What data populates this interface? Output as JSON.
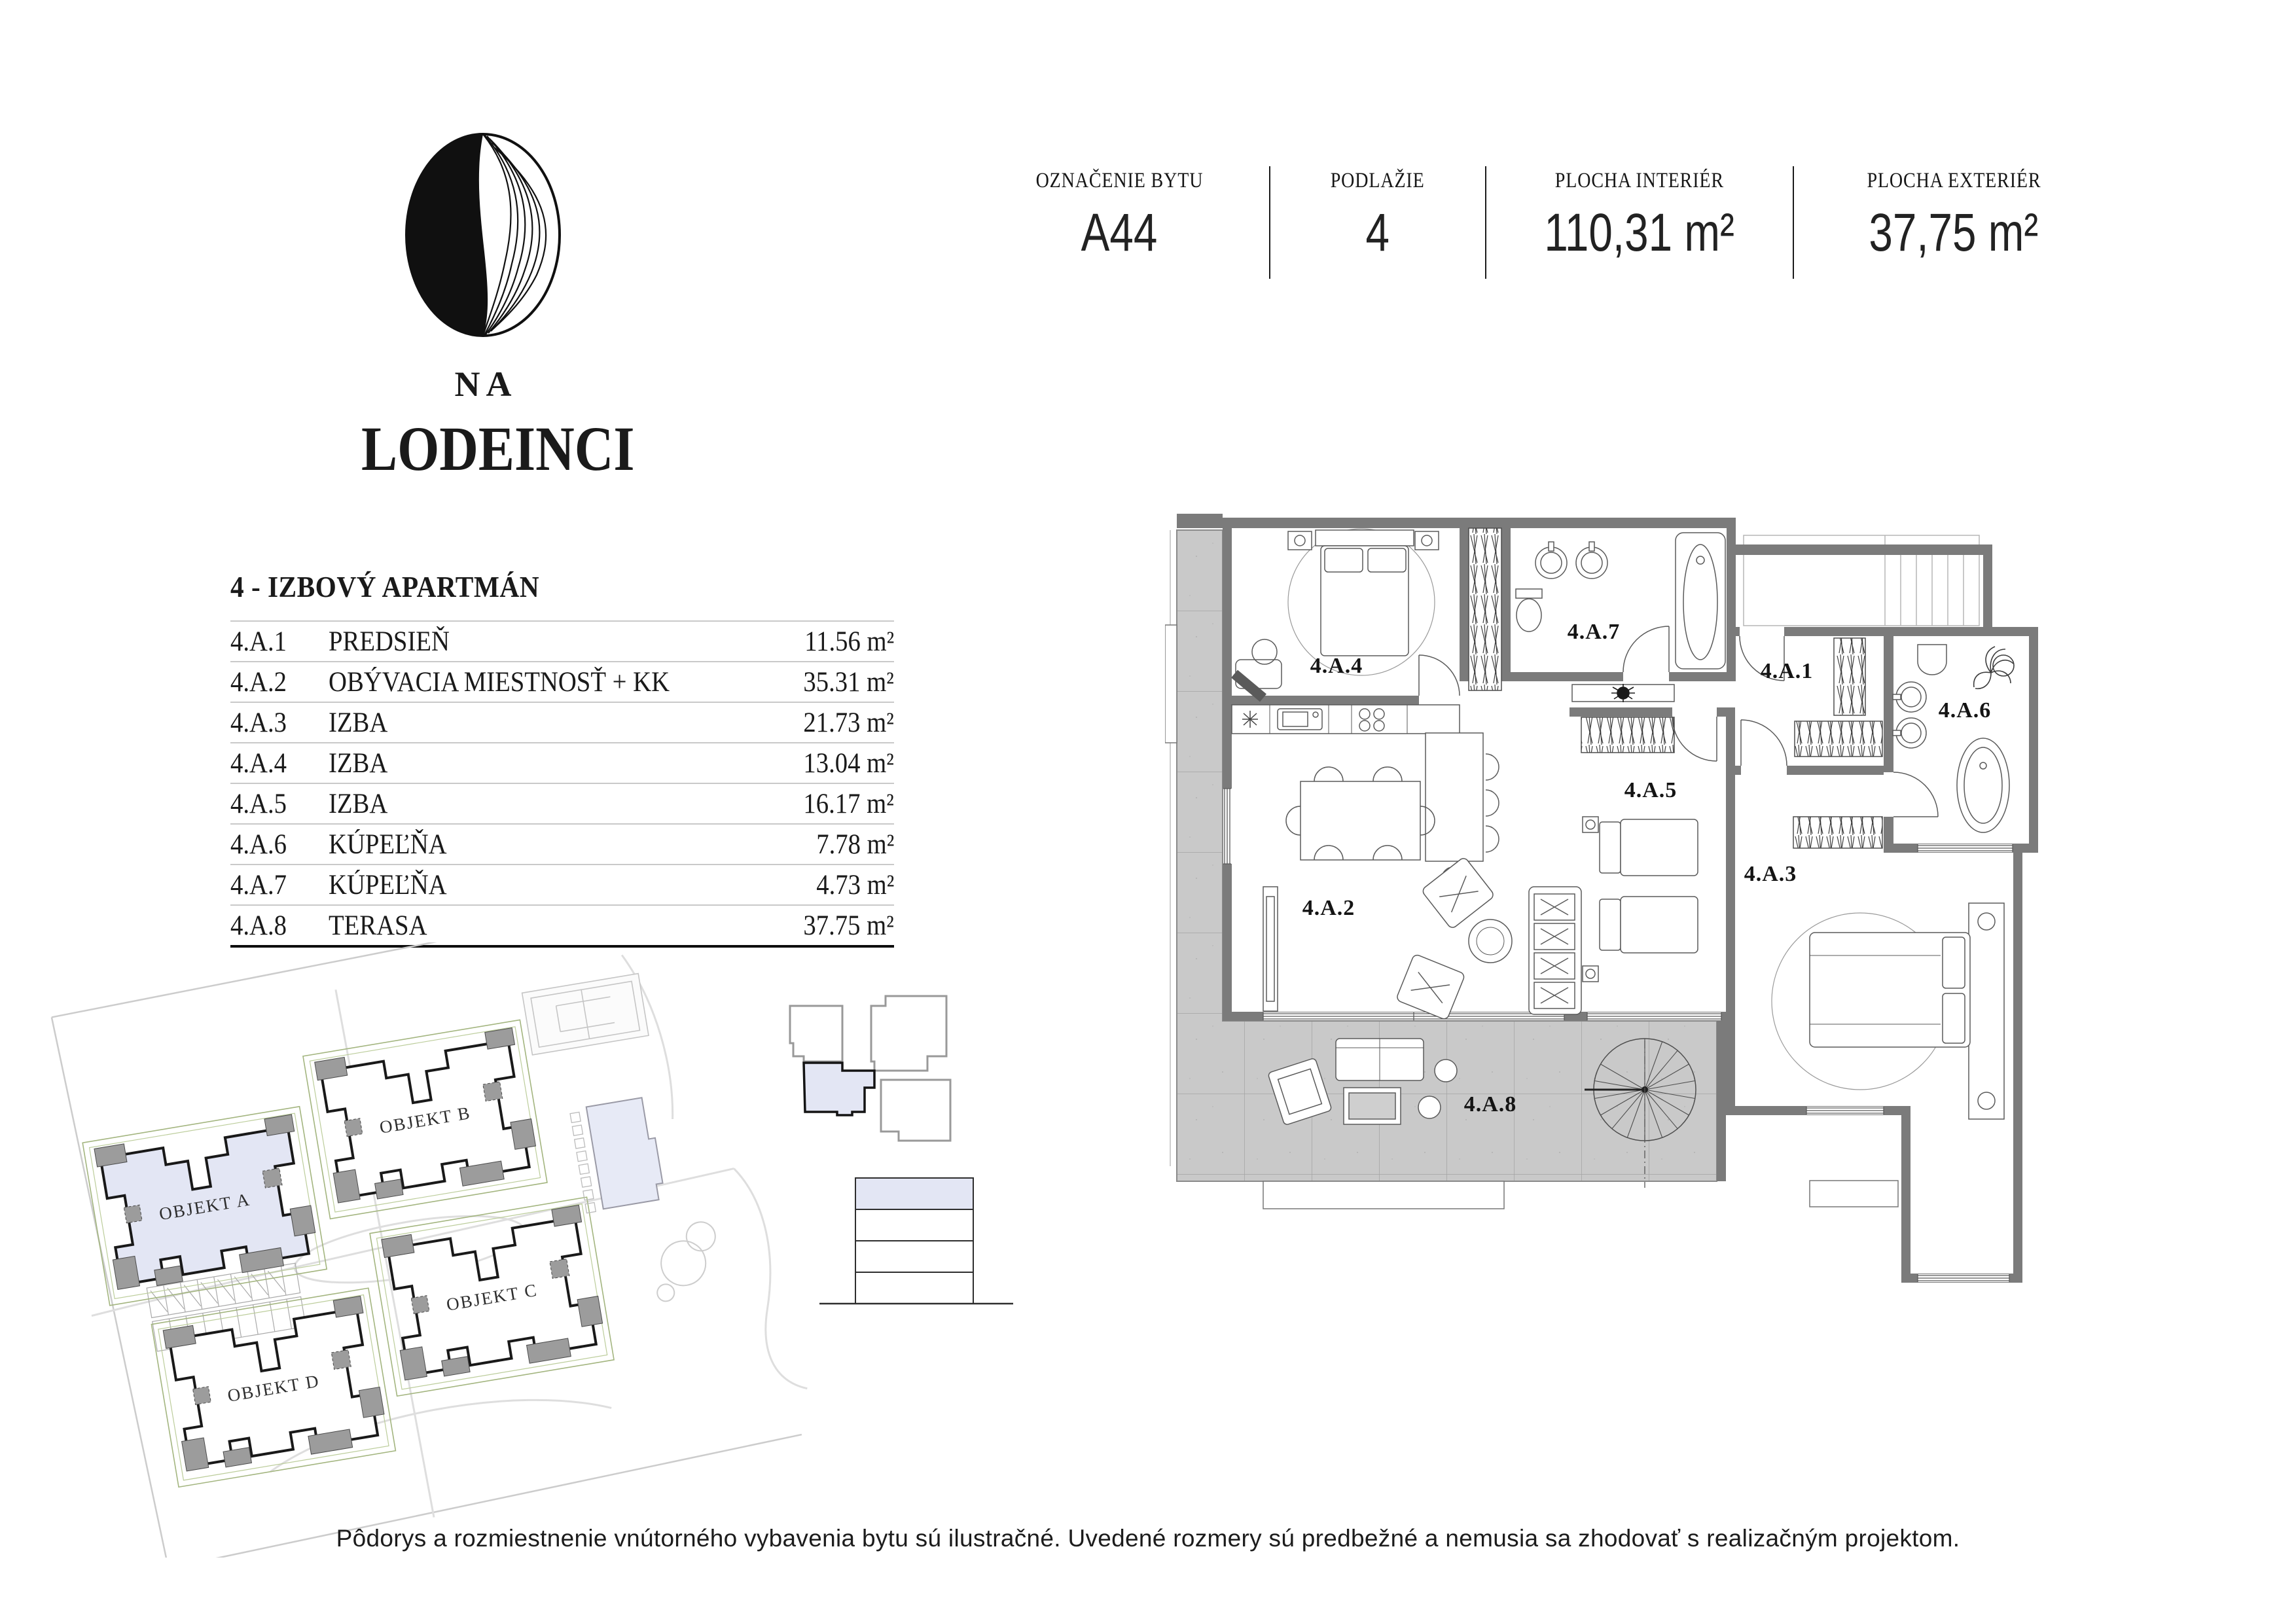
{
  "logo": {
    "prefix": "NA",
    "name": "LODEINCI"
  },
  "header": {
    "columns": [
      {
        "label": "OZNAČENIE BYTU",
        "value": "A44"
      },
      {
        "label": "PODLAŽIE",
        "value": "4"
      },
      {
        "label": "PLOCHA INTERIÉR",
        "value": "110,31 m²"
      },
      {
        "label": "PLOCHA EXTERIÉR",
        "value": "37,75 m²"
      }
    ]
  },
  "apartment": {
    "title": "4 - IZBOVÝ APARTMÁN",
    "rows": [
      {
        "code": "4.A.1",
        "name": "PREDSIEŇ",
        "area": "11.56 m²"
      },
      {
        "code": "4.A.2",
        "name": "OBÝVACIA MIESTNOSŤ + KK",
        "area": "35.31 m²"
      },
      {
        "code": "4.A.3",
        "name": "IZBA",
        "area": "21.73 m²"
      },
      {
        "code": "4.A.4",
        "name": "IZBA",
        "area": "13.04 m²"
      },
      {
        "code": "4.A.5",
        "name": "IZBA",
        "area": "16.17 m²"
      },
      {
        "code": "4.A.6",
        "name": "KÚPEĽŇA",
        "area": "7.78 m²"
      },
      {
        "code": "4.A.7",
        "name": "KÚPEĽŇA",
        "area": "4.73 m²"
      },
      {
        "code": "4.A.8",
        "name": "TERASA",
        "area": "37.75 m²"
      }
    ]
  },
  "floor_plan": {
    "rooms": {
      "a1": "4.A.1",
      "a2": "4.A.2",
      "a3": "4.A.3",
      "a4": "4.A.4",
      "a5": "4.A.5",
      "a6": "4.A.6",
      "a7": "4.A.7",
      "a8": "4.A.8"
    }
  },
  "site_plan": {
    "buildings": [
      "OBJEKT A",
      "OBJEKT B",
      "OBJEKT C",
      "OBJEKT D"
    ]
  },
  "disclaimer": "Pôdorys a rozmiestnenie vnútorného vybavenia bytu sú ilustračné. Uvedené rozmery sú predbežné a nemusia sa zhodovať s realizačným projektom."
}
